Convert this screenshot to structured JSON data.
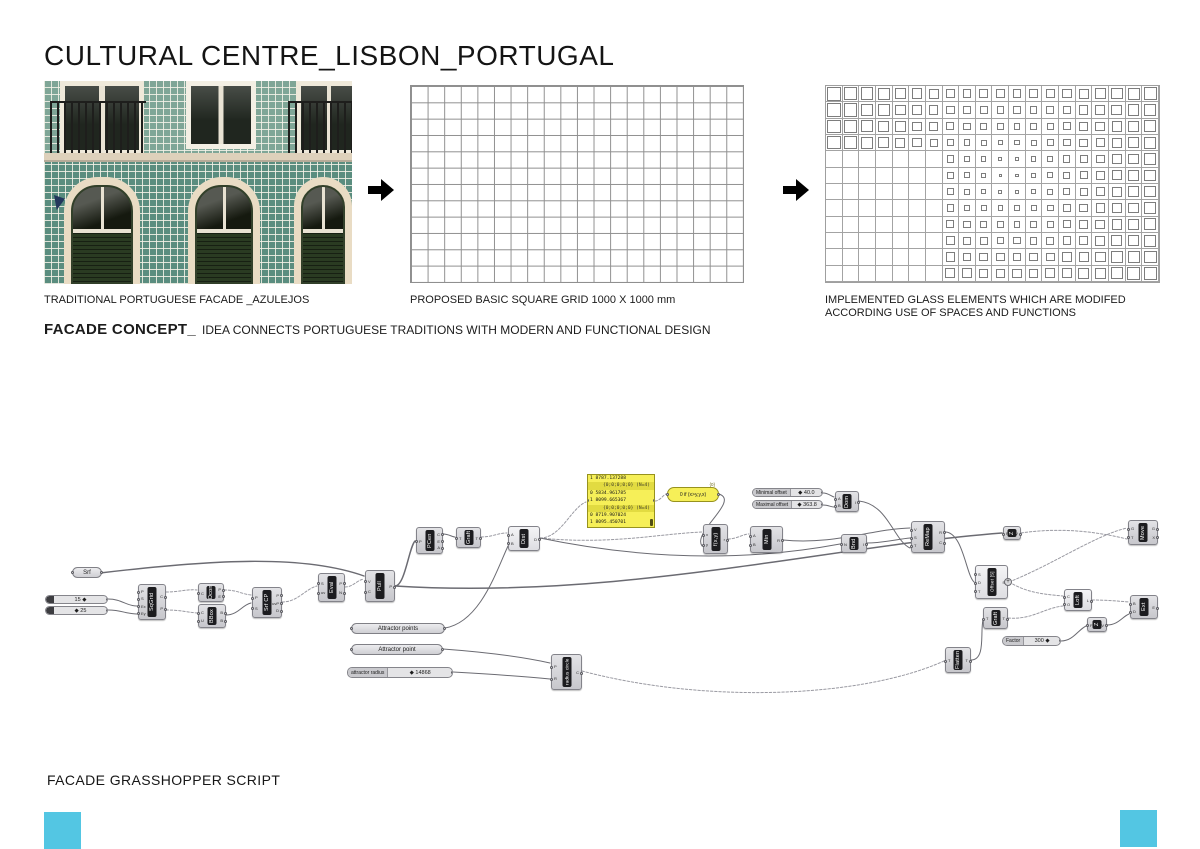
{
  "page": {
    "title": "CULTURAL CENTRE_LISBON_PORTUGAL",
    "footer": "FACADE GRASSHOPPER SCRIPT",
    "accent": "#53c6e3"
  },
  "top": {
    "photo_caption": "TRADITIONAL PORTUGUESE FACADE _AZULEJOS",
    "grid_caption": "PROPOSED BASIC SQUARE GRID 1000 X 1000 mm",
    "glass_caption": "IMPLEMENTED GLASS ELEMENTS WHICH ARE MODIFED\nACCORDING USE OF SPACES AND FUNCTIONS"
  },
  "concept": {
    "heading": "FACADE CONCEPT_",
    "body": "IDEA CONNECTS PORTUGUESE TRADITIONS WITH MODERN AND FUNCTIONAL DESIGN"
  },
  "grids": {
    "basic": {
      "cols": 20,
      "rows": 12
    },
    "glass": {
      "cols": 20,
      "rows": 12,
      "attractor": [
        11,
        5.5
      ],
      "dmax": 12.3,
      "min_ratio": 0.15,
      "ratio_gain": 0.75,
      "max_ratio": 0.88,
      "empty_max_col": 6,
      "empty_min_row": 4
    }
  },
  "script": {
    "nodes": [
      {
        "id": "srf-param",
        "kind": "capsule",
        "x": 72,
        "y": 567,
        "w": 30,
        "h": 11,
        "label": "Srf"
      },
      {
        "id": "slider-15",
        "kind": "slider",
        "x": 45,
        "y": 595,
        "w": 63,
        "h": 9,
        "name": "",
        "value": "15 ◆"
      },
      {
        "id": "slider-25",
        "kind": "slider",
        "x": 45,
        "y": 606,
        "w": 63,
        "h": 9,
        "name": "",
        "value": "◆ 25"
      },
      {
        "id": "sqgrid",
        "kind": "comp",
        "x": 138,
        "y": 584,
        "w": 28,
        "h": 36,
        "label": "SqGrid",
        "ins": [
          "P",
          "S",
          "Ex",
          "Ey"
        ],
        "outs": [
          "C",
          "P"
        ]
      },
      {
        "id": "dcon",
        "kind": "comp",
        "x": 198,
        "y": 583,
        "w": 26,
        "h": 19,
        "label": "Dcon",
        "ins": [
          "C"
        ],
        "outs": [
          "P",
          "E"
        ]
      },
      {
        "id": "bbox",
        "kind": "comp",
        "x": 198,
        "y": 604,
        "w": 28,
        "h": 24,
        "label": "BBox",
        "ins": [
          "C",
          "U"
        ],
        "outs": [
          "B",
          "B"
        ]
      },
      {
        "id": "srf-cp",
        "kind": "comp",
        "x": 252,
        "y": 587,
        "w": 30,
        "h": 31,
        "label": "Srf CP",
        "ins": [
          "P",
          "S"
        ],
        "outs": [
          "P",
          "uvP",
          "D"
        ]
      },
      {
        "id": "eval",
        "kind": "comp",
        "x": 318,
        "y": 573,
        "w": 27,
        "h": 29,
        "label": "Eval",
        "ins": [
          "S",
          "uv"
        ],
        "outs": [
          "P",
          "N"
        ]
      },
      {
        "id": "pull",
        "kind": "comp",
        "x": 365,
        "y": 570,
        "w": 30,
        "h": 32,
        "label": "Pull",
        "ins": [
          "V",
          "C"
        ],
        "outs": [
          "P"
        ]
      },
      {
        "id": "pcen",
        "kind": "comp",
        "x": 416,
        "y": 527,
        "w": 27,
        "h": 27,
        "label": "PCen",
        "ins": [
          "P"
        ],
        "outs": [
          "C",
          "E",
          "A"
        ]
      },
      {
        "id": "graft-1",
        "kind": "comp",
        "x": 456,
        "y": 527,
        "w": 25,
        "h": 21,
        "label": "Graft",
        "ins": [
          "T"
        ],
        "outs": [
          "T"
        ]
      },
      {
        "id": "dist",
        "kind": "comp",
        "x": 508,
        "y": 526,
        "w": 32,
        "h": 25,
        "label": "Dist",
        "ins": [
          "A",
          "B"
        ],
        "outs": [
          "D"
        ],
        "light": true
      },
      {
        "id": "data-panel",
        "kind": "panel",
        "x": 587,
        "y": 474,
        "w": 68,
        "h": 54,
        "rows": [
          "1 8787.137288",
          "{0;0;0;0;0} (N=4)",
          "0 5834.961785",
          "1 8099.665367",
          "{0;0;0;0;0} (N=4)",
          "0 8719.907024",
          "1 8095.450701"
        ]
      },
      {
        "id": "expression",
        "kind": "expr",
        "x": 667,
        "y": 487,
        "w": 52,
        "h": 15,
        "label": "0 if (x>y,y,x)",
        "tag": "{0}"
      },
      {
        "id": "fxy",
        "kind": "comp",
        "x": 703,
        "y": 524,
        "w": 25,
        "h": 30,
        "label": "f(x,y)",
        "ins": [
          "x",
          "y"
        ],
        "outs": [
          "r"
        ]
      },
      {
        "id": "min",
        "kind": "comp",
        "x": 750,
        "y": 526,
        "w": 33,
        "h": 27,
        "label": "Min",
        "ins": [
          "A",
          "B"
        ],
        "outs": [
          "R"
        ]
      },
      {
        "id": "slider-min-offset",
        "kind": "slider",
        "x": 752,
        "y": 488,
        "w": 71,
        "h": 9,
        "name": "Minimal offset",
        "value": "◆ 40.0"
      },
      {
        "id": "slider-max-offset",
        "kind": "slider",
        "x": 752,
        "y": 500,
        "w": 71,
        "h": 9,
        "name": "Maximal offset",
        "value": "◆ 363.8"
      },
      {
        "id": "dom",
        "kind": "comp",
        "x": 835,
        "y": 491,
        "w": 24,
        "h": 21,
        "label": "Dom",
        "ins": [
          "A",
          "B"
        ],
        "outs": [
          "I"
        ]
      },
      {
        "id": "bnd",
        "kind": "comp",
        "x": 841,
        "y": 534,
        "w": 26,
        "h": 19,
        "label": "Bnd",
        "ins": [
          "N"
        ],
        "outs": [
          "I"
        ]
      },
      {
        "id": "remap",
        "kind": "comp",
        "x": 911,
        "y": 521,
        "w": 34,
        "h": 32,
        "label": "ReMap",
        "ins": [
          "V",
          "S",
          "T"
        ],
        "outs": [
          "R",
          "C"
        ]
      },
      {
        "id": "unit-z",
        "kind": "comp",
        "x": 1003,
        "y": 526,
        "w": 18,
        "h": 14,
        "label": "Z",
        "ins": [
          "F"
        ],
        "outs": [
          "V"
        ]
      },
      {
        "id": "move",
        "kind": "comp",
        "x": 1128,
        "y": 520,
        "w": 30,
        "h": 25,
        "label": "Move",
        "ins": [
          "G",
          "T"
        ],
        "outs": [
          "G",
          "X"
        ]
      },
      {
        "id": "offset-s",
        "kind": "comp",
        "x": 975,
        "y": 565,
        "w": 33,
        "h": 34,
        "label": "Offset [S]",
        "ins": [
          "S",
          "D",
          "T"
        ],
        "outs": [
          "S"
        ],
        "light": true,
        "plus": true
      },
      {
        "id": "graft-2",
        "kind": "comp",
        "x": 983,
        "y": 607,
        "w": 25,
        "h": 22,
        "label": "Graft",
        "ins": [
          "T"
        ],
        "outs": [
          "T"
        ]
      },
      {
        "id": "loft",
        "kind": "comp",
        "x": 1064,
        "y": 589,
        "w": 28,
        "h": 22,
        "label": "Loft",
        "ins": [
          "C",
          "O"
        ],
        "outs": [
          "L"
        ],
        "light": true
      },
      {
        "id": "ext",
        "kind": "comp",
        "x": 1130,
        "y": 595,
        "w": 28,
        "h": 24,
        "label": "Ext",
        "ins": [
          "B",
          "D"
        ],
        "outs": [
          "E"
        ]
      },
      {
        "id": "vec-z",
        "kind": "comp",
        "x": 1087,
        "y": 617,
        "w": 20,
        "h": 15,
        "label": "Z",
        "ins": [
          "F"
        ],
        "outs": [
          "V"
        ]
      },
      {
        "id": "slider-factor",
        "kind": "slider",
        "x": 1002,
        "y": 636,
        "w": 59,
        "h": 10,
        "name": "Factor",
        "value": "300 ◆"
      },
      {
        "id": "flatten",
        "kind": "comp",
        "x": 945,
        "y": 647,
        "w": 26,
        "h": 26,
        "label": "Flatten",
        "ins": [
          "T"
        ],
        "outs": [
          "T"
        ]
      },
      {
        "id": "attractor-points",
        "kind": "capsule",
        "x": 351,
        "y": 623,
        "w": 94,
        "h": 11,
        "label": "Attractor points"
      },
      {
        "id": "attractor-point",
        "kind": "capsule",
        "x": 351,
        "y": 644,
        "w": 92,
        "h": 11,
        "label": "Attractor point"
      },
      {
        "id": "slider-attractor-radius",
        "kind": "slider",
        "x": 347,
        "y": 667,
        "w": 106,
        "h": 11,
        "name": "attractor radius",
        "value": "◆ 14868"
      },
      {
        "id": "radius-circle",
        "kind": "comp",
        "x": 551,
        "y": 654,
        "w": 31,
        "h": 36,
        "label": "radius circle",
        "ins": [
          "P",
          "R"
        ],
        "outs": [
          "C"
        ]
      }
    ],
    "wires": [
      {
        "d": "M100 573 C210 560,302 554,364 576",
        "dash": false,
        "w": 1.4
      },
      {
        "d": "M108 599 C122 599,126 606,137 606",
        "dash": false,
        "w": 1
      },
      {
        "d": "M108 610 C122 610,126 614,137 614",
        "dash": false,
        "w": 1
      },
      {
        "d": "M166 592 C180 592,186 589,197 590",
        "dash": true,
        "w": 1
      },
      {
        "d": "M166 610 C180 610,186 612,197 613",
        "dash": true,
        "w": 1
      },
      {
        "d": "M224 590 C238 590,241 594,251 595",
        "dash": true,
        "w": 1
      },
      {
        "d": "M226 615 C238 615,242 605,251 603",
        "dash": false,
        "w": 1
      },
      {
        "d": "M282 602 C298 602,305 589,317 586",
        "dash": true,
        "w": 1
      },
      {
        "d": "M345 587 C353 587,357 580,364 579",
        "dash": true,
        "w": 1
      },
      {
        "d": "M395 586 C405 586,409 547,415 541",
        "dash": false,
        "w": 1.5
      },
      {
        "d": "M395 586 C620 600,830 546,1002 533",
        "dash": false,
        "w": 1.5
      },
      {
        "d": "M443 534 C449 534,452 537,455 537",
        "dash": false,
        "w": 1
      },
      {
        "d": "M481 537 C492 537,498 533,507 533",
        "dash": true,
        "w": 1
      },
      {
        "d": "M445 628 C480 622,496 572,508 546",
        "dash": false,
        "w": 1
      },
      {
        "d": "M540 538 C561 538,571 508,586 502",
        "dash": true,
        "w": 1
      },
      {
        "d": "M540 538 C610 545,657 534,702 532",
        "dash": true,
        "w": 1
      },
      {
        "d": "M655 501 C660 501,663 495,666 494",
        "dash": true,
        "w": 1
      },
      {
        "d": "M719 494 C740 501,692 532,702 546",
        "dash": false,
        "w": 1
      },
      {
        "d": "M728 539 C737 539,743 534,749 534",
        "dash": true,
        "w": 1
      },
      {
        "d": "M783 540 C835 545,872 529,910 528",
        "dash": false,
        "w": 1
      },
      {
        "d": "M540 538 C665 564,765 558,840 544",
        "dash": false,
        "w": 1
      },
      {
        "d": "M867 543 C884 543,898 539,910 538",
        "dash": false,
        "w": 1
      },
      {
        "d": "M823 493 C828 493,831 496,834 497",
        "dash": false,
        "w": 1
      },
      {
        "d": "M823 505 C828 505,831 507,834 507",
        "dash": false,
        "w": 1
      },
      {
        "d": "M859 501 C888 504,894 541,910 548",
        "dash": false,
        "w": 1
      },
      {
        "d": "M945 532 C963 532,966 575,974 582",
        "dash": false,
        "w": 1
      },
      {
        "d": "M1009 582 C1054 564,1096 535,1127 528",
        "dash": true,
        "w": 1
      },
      {
        "d": "M1021 533 C1062 527,1098 532,1127 539",
        "dash": true,
        "w": 1
      },
      {
        "d": "M1009 582 C1026 592,1040 594,1063 596",
        "dash": true,
        "w": 1
      },
      {
        "d": "M1008 618 C1032 620,1044 608,1063 606",
        "dash": true,
        "w": 1
      },
      {
        "d": "M1061 641 C1073 641,1078 630,1086 626",
        "dash": false,
        "w": 1
      },
      {
        "d": "M1107 625 C1118 625,1122 617,1129 614",
        "dash": false,
        "w": 1
      },
      {
        "d": "M1092 600 C1106 600,1117 601,1129 602",
        "dash": true,
        "w": 1
      },
      {
        "d": "M443 649 C484 652,518 656,550 663",
        "dash": false,
        "w": 1
      },
      {
        "d": "M453 672 C488 674,520 676,550 679",
        "dash": false,
        "w": 1
      },
      {
        "d": "M582 671 C706 704,862 698,944 661",
        "dash": true,
        "w": 1
      },
      {
        "d": "M971 660 C986 660,980 632,983 620",
        "dash": false,
        "w": 1
      }
    ]
  }
}
